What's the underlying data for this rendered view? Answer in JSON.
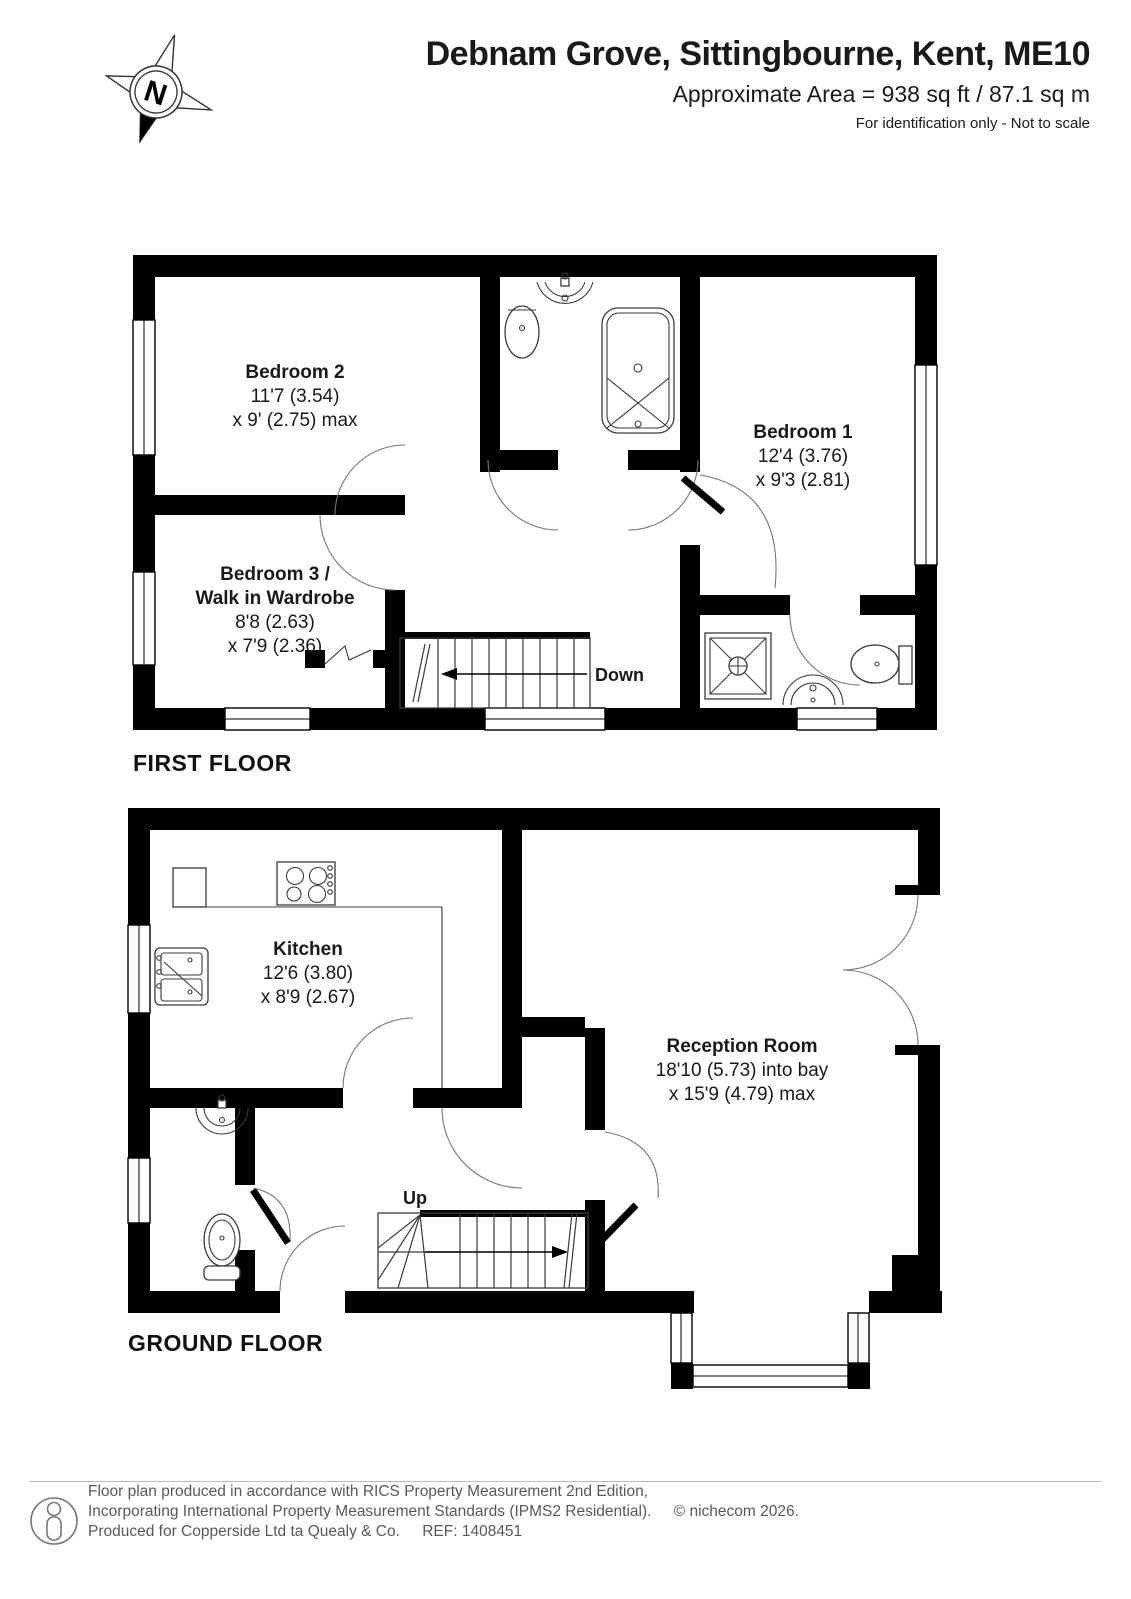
{
  "header": {
    "title": "Debnam Grove, Sittingbourne, Kent, ME10",
    "area_line": "Approximate Area = 938 sq ft / 87.1 sq m",
    "disclaimer": "For identification only - Not to scale"
  },
  "compass": {
    "label": "N"
  },
  "first_floor": {
    "label": "FIRST FLOOR",
    "stairs_label": "Down",
    "rooms": [
      {
        "name": "Bedroom 2",
        "dim1": "11'7 (3.54)",
        "dim2": "x 9' (2.75) max"
      },
      {
        "name": "Bedroom 1",
        "dim1": "12'4 (3.76)",
        "dim2": "x 9'3 (2.81)"
      },
      {
        "name": "Bedroom 3 /",
        "name2": "Walk in Wardrobe",
        "dim1": "8'8 (2.63)",
        "dim2": "x 7'9 (2.36)"
      }
    ]
  },
  "ground_floor": {
    "label": "GROUND FLOOR",
    "stairs_label": "Up",
    "rooms": [
      {
        "name": "Kitchen",
        "dim1": "12'6 (3.80)",
        "dim2": "x 8'9 (2.67)"
      },
      {
        "name": "Reception Room",
        "dim1": "18'10 (5.73) into bay",
        "dim2": "x 15'9 (4.79) max"
      }
    ]
  },
  "footer": {
    "line1": "Floor plan produced in accordance with RICS Property Measurement 2nd Edition,",
    "line2": "Incorporating International Property Measurement Standards (IPMS2 Residential).",
    "line2b": "© nichecom 2026.",
    "line3": "Produced for Copperside Ltd ta Quealy & Co.",
    "line3b": "REF: 1408451"
  },
  "colors": {
    "wall": "#000000",
    "text": "#1a1a1a",
    "footer_text": "#595959"
  }
}
